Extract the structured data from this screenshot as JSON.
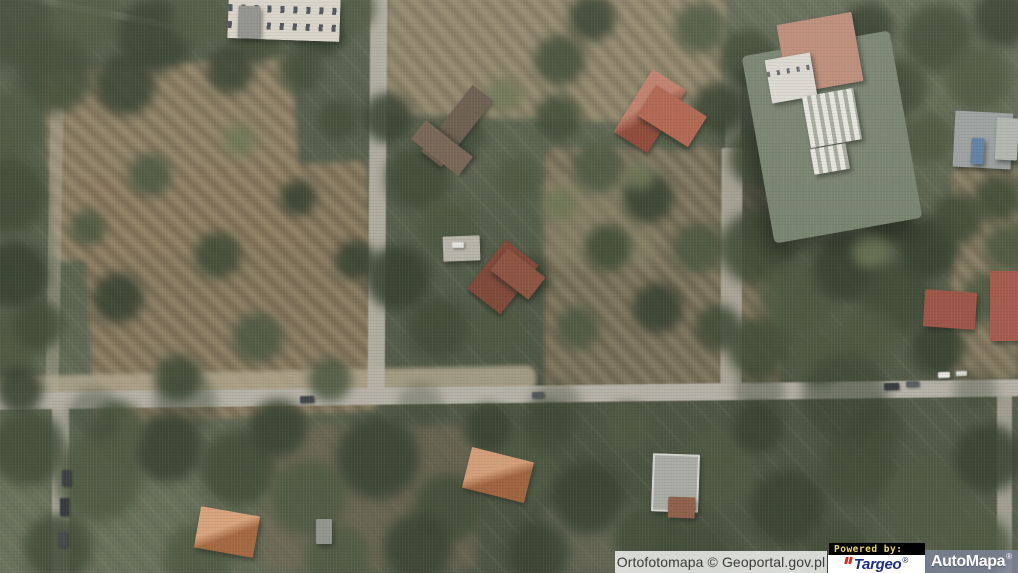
{
  "window": {
    "width": 1018,
    "height": 573
  },
  "attribution": {
    "text": "Ortofotomapa © Geoportal.gov.pl",
    "background": "rgba(255,255,255,0.78)",
    "text_color": "#3b3b3b"
  },
  "branding": {
    "powered_by": "Powered by:",
    "powered_by_bg": "#000000",
    "powered_by_fg": "#e8d27c",
    "targeo": {
      "name": "Targeo",
      "registered": "®",
      "text_color": "#1c2f80",
      "mark_color": "#d42d20",
      "bg": "#ffffff"
    },
    "automapa": {
      "name": "AutoMapa",
      "registered": "®",
      "text_color": "#ffffff",
      "bg": "rgba(130,136,160,0.75)"
    }
  },
  "map": {
    "type": "aerial-orthophoto",
    "scene": "suburban forest district with felled-tree clearings, a grid of sandy streets, a large institutional building and scattered villas",
    "palette": {
      "canopy": [
        "#39452f",
        "#46523a",
        "#2f3a28",
        "#4e5a40",
        "#6a7250"
      ],
      "ground_brown": "#8b7b5f",
      "road_gray": "#b4b0a6",
      "shadow": "#2e352b"
    },
    "patches": [
      {
        "n": "felled-area-left",
        "x": 48,
        "y": 64,
        "w": 250,
        "h": 190,
        "r": -4,
        "c": "#8b7b5f",
        "s": 1,
        "o": 0.92,
        "b": 3
      },
      {
        "n": "felled-area-left-lower",
        "x": 88,
        "y": 168,
        "w": 285,
        "h": 250,
        "r": -3,
        "c": "#857459",
        "s": 1,
        "o": 0.9,
        "b": 3
      },
      {
        "n": "felled-area-top-center",
        "x": 385,
        "y": -10,
        "w": 340,
        "h": 130,
        "r": 2,
        "c": "#94866a",
        "s": 1,
        "o": 0.85,
        "b": 3
      },
      {
        "n": "felled-area-center",
        "x": 545,
        "y": 148,
        "w": 235,
        "h": 245,
        "r": 0,
        "c": "#7f7158",
        "s": 1,
        "o": 0.8,
        "b": 3
      },
      {
        "n": "lawn-center",
        "x": 545,
        "y": 175,
        "w": 110,
        "h": 90,
        "r": 0,
        "c": "#8a8668",
        "s": 0,
        "o": 0.5,
        "b": 6
      },
      {
        "n": "felled-area-right-edge",
        "x": 952,
        "y": 165,
        "w": 66,
        "h": 215,
        "r": 0,
        "c": "#8a7b60",
        "s": 1,
        "o": 0.8,
        "b": 3
      },
      {
        "n": "clearing-below-road",
        "x": 262,
        "y": 425,
        "w": 215,
        "h": 145,
        "r": 0,
        "c": "#6e6450",
        "s": 1,
        "o": 0.55,
        "b": 5
      },
      {
        "n": "clearing-below-road-2",
        "x": 545,
        "y": 505,
        "w": 115,
        "h": 70,
        "r": 0,
        "c": "#74705c",
        "s": 0,
        "o": 0.55,
        "b": 6
      },
      {
        "n": "dirt-shoulder",
        "x": -4,
        "y": 371,
        "w": 540,
        "h": 26,
        "r": -1.2,
        "c": "#b0a58a",
        "s": 0,
        "o": 0.85,
        "b": 2
      },
      {
        "n": "building-shadow",
        "x": 722,
        "y": 112,
        "w": 44,
        "h": 135,
        "r": -10,
        "c": "#2e352b",
        "s": 0,
        "o": 0.55,
        "b": 7
      }
    ],
    "roads": [
      {
        "n": "main-road",
        "x": -6,
        "y": 386,
        "w": 1030,
        "h": 17,
        "r": -0.75,
        "c": "#b4b0a6",
        "o": 1
      },
      {
        "n": "side-street-left",
        "x": 52,
        "y": 400,
        "w": 17,
        "h": 175,
        "r": 0,
        "c": "#b1ac9f",
        "o": 0.9
      },
      {
        "n": "path-left-upper",
        "x": 48,
        "y": 108,
        "w": 13,
        "h": 284,
        "r": 1,
        "c": "#b2ab99",
        "o": 0.45
      },
      {
        "n": "street-center",
        "x": 369,
        "y": -2,
        "w": 17,
        "h": 394,
        "r": 0.4,
        "c": "#b7b3a8",
        "o": 0.9
      },
      {
        "n": "street-mid-right",
        "x": 721,
        "y": 148,
        "w": 21,
        "h": 248,
        "r": 0.3,
        "c": "#b1ac9f",
        "o": 0.85
      },
      {
        "n": "street-mid-right-upper",
        "x": 725,
        "y": 58,
        "w": 16,
        "h": 95,
        "r": 0,
        "c": "#ada795",
        "o": 0.35
      },
      {
        "n": "path-right-lower",
        "x": 997,
        "y": 394,
        "w": 15,
        "h": 180,
        "r": 0,
        "c": "#b3aea2",
        "o": 0.8
      },
      {
        "n": "path-top-left",
        "x": -12,
        "y": 6,
        "w": 195,
        "h": 7,
        "r": 11,
        "c": "#b6b0a2",
        "o": 0.5
      }
    ],
    "forest_blobs": [
      [
        15,
        25,
        48,
        0
      ],
      [
        85,
        18,
        40,
        1
      ],
      [
        155,
        35,
        42,
        2
      ],
      [
        55,
        75,
        42,
        0
      ],
      [
        10,
        125,
        38,
        1
      ],
      [
        125,
        85,
        34,
        2
      ],
      [
        200,
        18,
        32,
        1
      ],
      [
        255,
        38,
        28,
        0
      ],
      [
        320,
        28,
        32,
        2
      ],
      [
        352,
        8,
        26,
        1
      ],
      [
        230,
        70,
        26,
        2
      ],
      [
        300,
        70,
        24,
        0
      ],
      [
        8,
        195,
        42,
        0
      ],
      [
        14,
        275,
        38,
        2
      ],
      [
        5,
        345,
        38,
        1
      ],
      [
        38,
        325,
        28,
        0
      ],
      [
        20,
        390,
        26,
        2
      ],
      [
        150,
        175,
        24,
        1
      ],
      [
        218,
        255,
        26,
        0
      ],
      [
        118,
        298,
        28,
        2
      ],
      [
        258,
        338,
        28,
        1
      ],
      [
        178,
        378,
        26,
        0
      ],
      [
        298,
        198,
        20,
        2
      ],
      [
        88,
        228,
        20,
        1
      ],
      [
        338,
        120,
        22,
        0
      ],
      [
        355,
        260,
        22,
        2
      ],
      [
        330,
        380,
        24,
        1
      ],
      [
        240,
        140,
        18,
        4
      ],
      [
        418,
        178,
        36,
        0
      ],
      [
        448,
        228,
        32,
        1
      ],
      [
        398,
        278,
        36,
        2
      ],
      [
        438,
        328,
        34,
        0
      ],
      [
        498,
        328,
        28,
        1
      ],
      [
        388,
        118,
        28,
        2
      ],
      [
        518,
        178,
        24,
        1
      ],
      [
        465,
        135,
        22,
        0
      ],
      [
        505,
        95,
        20,
        4
      ],
      [
        558,
        118,
        26,
        0
      ],
      [
        598,
        168,
        28,
        1
      ],
      [
        648,
        198,
        28,
        2
      ],
      [
        608,
        248,
        26,
        0
      ],
      [
        698,
        248,
        28,
        1
      ],
      [
        658,
        308,
        28,
        2
      ],
      [
        718,
        328,
        26,
        0
      ],
      [
        578,
        328,
        24,
        1
      ],
      [
        528,
        278,
        24,
        2
      ],
      [
        560,
        205,
        18,
        4
      ],
      [
        640,
        175,
        16,
        4
      ],
      [
        560,
        60,
        28,
        0
      ],
      [
        592,
        18,
        26,
        2
      ],
      [
        700,
        28,
        28,
        1
      ],
      [
        748,
        58,
        32,
        0
      ],
      [
        718,
        108,
        28,
        2
      ],
      [
        678,
        128,
        24,
        1
      ],
      [
        758,
        158,
        32,
        0
      ],
      [
        798,
        178,
        28,
        2
      ],
      [
        758,
        248,
        42,
        0
      ],
      [
        798,
        298,
        42,
        1
      ],
      [
        848,
        268,
        38,
        2
      ],
      [
        898,
        298,
        40,
        0
      ],
      [
        868,
        338,
        34,
        1
      ],
      [
        928,
        248,
        34,
        2
      ],
      [
        958,
        218,
        28,
        0
      ],
      [
        988,
        298,
        28,
        1
      ],
      [
        938,
        348,
        30,
        2
      ],
      [
        758,
        348,
        34,
        0
      ],
      [
        818,
        358,
        30,
        1
      ],
      [
        888,
        218,
        30,
        2
      ],
      [
        998,
        198,
        26,
        0
      ],
      [
        1008,
        248,
        26,
        1
      ],
      [
        870,
        250,
        20,
        4
      ],
      [
        938,
        38,
        38,
        0
      ],
      [
        978,
        78,
        36,
        1
      ],
      [
        1002,
        18,
        32,
        2
      ],
      [
        898,
        88,
        32,
        0
      ],
      [
        928,
        138,
        28,
        1
      ],
      [
        868,
        28,
        28,
        2
      ],
      [
        28,
        448,
        42,
        0
      ],
      [
        98,
        478,
        48,
        1
      ],
      [
        168,
        448,
        38,
        2
      ],
      [
        238,
        468,
        42,
        0
      ],
      [
        308,
        498,
        42,
        1
      ],
      [
        378,
        458,
        46,
        2
      ],
      [
        448,
        508,
        38,
        0
      ],
      [
        518,
        468,
        42,
        1
      ],
      [
        588,
        498,
        40,
        2
      ],
      [
        648,
        538,
        38,
        0
      ],
      [
        718,
        468,
        46,
        1
      ],
      [
        788,
        508,
        42,
        2
      ],
      [
        858,
        468,
        42,
        0
      ],
      [
        928,
        498,
        46,
        1
      ],
      [
        988,
        458,
        38,
        2
      ],
      [
        58,
        548,
        38,
        0
      ],
      [
        198,
        558,
        38,
        1
      ],
      [
        418,
        548,
        38,
        2
      ],
      [
        698,
        558,
        38,
        0
      ],
      [
        978,
        548,
        38,
        1
      ],
      [
        278,
        428,
        32,
        2
      ],
      [
        548,
        428,
        28,
        0
      ],
      [
        628,
        428,
        28,
        1
      ],
      [
        758,
        428,
        28,
        2
      ],
      [
        878,
        428,
        28,
        0
      ],
      [
        338,
        558,
        36,
        1
      ],
      [
        538,
        553,
        34,
        2
      ],
      [
        838,
        553,
        36,
        0
      ],
      [
        118,
        428,
        30,
        1
      ],
      [
        488,
        428,
        26,
        2
      ],
      [
        185,
        402,
        35,
        2,
        0.4
      ],
      [
        845,
        398,
        48,
        2,
        0.55
      ],
      [
        555,
        408,
        30,
        2,
        0.35
      ],
      [
        95,
        415,
        30,
        2,
        0.4
      ],
      [
        420,
        405,
        25,
        2,
        0.3
      ],
      [
        760,
        392,
        28,
        2,
        0.4
      ],
      [
        975,
        390,
        24,
        2,
        0.35
      ]
    ],
    "buildings": [
      {
        "n": "mansion-roof",
        "x": 228,
        "y": -2,
        "w": 112,
        "h": 42,
        "r": 2,
        "c": "#dad5ca",
        "cls": "mansion"
      },
      {
        "n": "mansion-tower",
        "x": 238,
        "y": 6,
        "w": 22,
        "h": 32,
        "r": 2,
        "c": "#8e8e8a"
      },
      {
        "n": "complex-main-roof",
        "x": 757,
        "y": 42,
        "w": 150,
        "h": 190,
        "r": -10,
        "c": "#75816d",
        "cls": "cplx"
      },
      {
        "n": "complex-salmon-roof",
        "x": 782,
        "y": 18,
        "w": 76,
        "h": 70,
        "r": -10,
        "c": "#bd8a76"
      },
      {
        "n": "complex-white-wing",
        "x": 768,
        "y": 56,
        "w": 46,
        "h": 44,
        "r": -10,
        "c": "#dcdad2",
        "cls": "dots"
      },
      {
        "n": "complex-skylights",
        "x": 806,
        "y": 92,
        "w": 52,
        "h": 52,
        "r": -10,
        "c": "#cfd0c8",
        "cls": "stripes"
      },
      {
        "n": "complex-skylights-2",
        "x": 812,
        "y": 146,
        "w": 36,
        "h": 26,
        "r": -10,
        "c": "#cfd0c8",
        "cls": "stripes"
      },
      {
        "n": "house-gray-ne",
        "x": 954,
        "y": 112,
        "w": 58,
        "h": 56,
        "r": 3,
        "c": "#9aa09f"
      },
      {
        "n": "house-gray-ne-annex",
        "x": 996,
        "y": 118,
        "w": 22,
        "h": 42,
        "r": 3,
        "c": "#b2b4ae"
      },
      {
        "n": "pool-blue",
        "x": 971,
        "y": 138,
        "w": 13,
        "h": 26,
        "r": 3,
        "c": "#5d7da0"
      },
      {
        "n": "house-brown-roof-wing-a",
        "x": 444,
        "y": 84,
        "w": 26,
        "h": 84,
        "r": 38,
        "c": "#675849"
      },
      {
        "n": "house-brown-roof-wing-b",
        "x": 430,
        "y": 118,
        "w": 24,
        "h": 60,
        "r": -52,
        "c": "#73604f"
      },
      {
        "n": "house-red-roof-main",
        "x": 630,
        "y": 74,
        "w": 40,
        "h": 74,
        "r": 32,
        "c": "#a5523f",
        "cls": "hipred"
      },
      {
        "n": "house-red-roof-wing",
        "x": 642,
        "y": 98,
        "w": 60,
        "h": 36,
        "r": 32,
        "c": "#b0614a"
      },
      {
        "n": "house-center-roof",
        "x": 482,
        "y": 246,
        "w": 42,
        "h": 62,
        "r": 38,
        "c": "#7c4233"
      },
      {
        "n": "house-center-wing",
        "x": 494,
        "y": 260,
        "w": 48,
        "h": 28,
        "r": 38,
        "c": "#8a4d3b"
      },
      {
        "n": "driveway-pad",
        "x": 443,
        "y": 236,
        "w": 37,
        "h": 25,
        "r": -2,
        "c": "#b6b3a8"
      },
      {
        "n": "house-orange-roof",
        "x": 466,
        "y": 454,
        "w": 64,
        "h": 42,
        "r": 14,
        "c": "#bf7448",
        "cls": "hip"
      },
      {
        "n": "modern-building-roof",
        "x": 652,
        "y": 454,
        "w": 47,
        "h": 58,
        "r": 2,
        "c": "#a9aba3",
        "cls": "parapet"
      },
      {
        "n": "modern-building-wing",
        "x": 668,
        "y": 497,
        "w": 27,
        "h": 21,
        "r": 2,
        "c": "#8a5942"
      },
      {
        "n": "house-orange-roof-sw",
        "x": 197,
        "y": 511,
        "w": 60,
        "h": 42,
        "r": 10,
        "c": "#c67c4a",
        "cls": "hip"
      },
      {
        "n": "shed-small",
        "x": 316,
        "y": 519,
        "w": 16,
        "h": 25,
        "r": 0,
        "c": "#8f9289"
      },
      {
        "n": "house-red-right-a",
        "x": 924,
        "y": 291,
        "w": 52,
        "h": 37,
        "r": 4,
        "c": "#9c4f42"
      },
      {
        "n": "house-red-right-b",
        "x": 990,
        "y": 271,
        "w": 28,
        "h": 70,
        "r": 0,
        "c": "#a35547"
      }
    ],
    "vehicles": [
      {
        "x": 300,
        "y": 396,
        "w": 14,
        "h": 7,
        "r": -2,
        "c": "#3a3e42"
      },
      {
        "x": 884,
        "y": 383,
        "w": 15,
        "h": 7,
        "r": -2,
        "c": "#2e3236"
      },
      {
        "x": 906,
        "y": 381,
        "w": 13,
        "h": 6,
        "r": -2,
        "c": "#53585d"
      },
      {
        "x": 938,
        "y": 372,
        "w": 12,
        "h": 6,
        "r": -2,
        "c": "#e8e8e6"
      },
      {
        "x": 956,
        "y": 371,
        "w": 11,
        "h": 5,
        "r": -2,
        "c": "#d8d8d4"
      },
      {
        "x": 532,
        "y": 392,
        "w": 12,
        "h": 6,
        "r": -2,
        "c": "#4a4e52"
      },
      {
        "x": 62,
        "y": 470,
        "w": 9,
        "h": 16,
        "r": 0,
        "c": "#33373b"
      },
      {
        "x": 60,
        "y": 498,
        "w": 9,
        "h": 18,
        "r": 0,
        "c": "#2c3034"
      },
      {
        "x": 58,
        "y": 532,
        "w": 9,
        "h": 15,
        "r": 0,
        "c": "#3d4145"
      },
      {
        "x": 452,
        "y": 242,
        "w": 12,
        "h": 6,
        "r": 0,
        "c": "#e5e5e1"
      }
    ]
  }
}
